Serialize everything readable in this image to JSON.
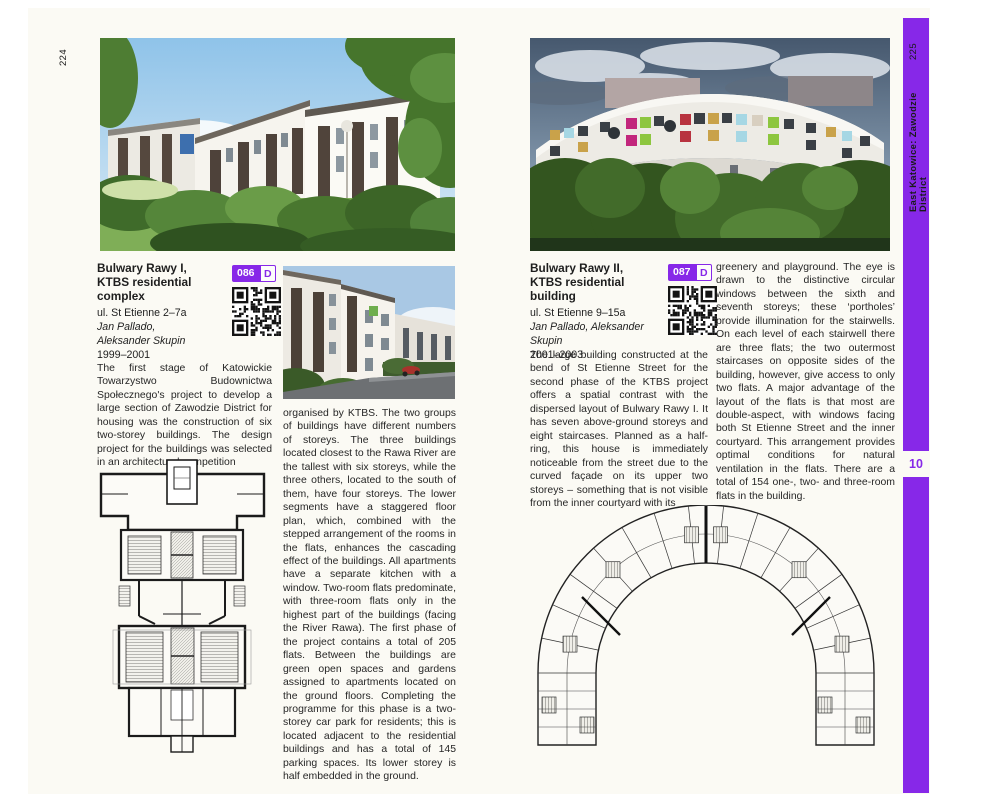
{
  "left_page": {
    "page_number": "224",
    "entry": {
      "title_line1": "Bulwary Rawy I,",
      "title_line2": "KTBS residential complex",
      "address": "ul. St Etienne 2–7a",
      "architect_line1": "Jan Pallado,",
      "architect_line2": "Aleksander Skupin",
      "years": "1999–2001",
      "badge_number": "086",
      "badge_letter": "D"
    },
    "col1_paragraph": "The first stage of Katowickie Towarzystwo Budownictwa Społecznego's project to develop a large section of Zawodzie District for housing was the construction of six two-storey buildings. The design project for the buildings was selected in an architectural competition",
    "col2_paragraph": "organised by KTBS. The two groups of buildings have different numbers of storeys. The three buildings located closest to the Rawa River are the tallest with six storeys, while the three others, located to the south of them, have four storeys. The lower segments have a staggered floor plan, which, combined with the stepped arrangement of the rooms in the flats, enhances the cascading effect of the buildings. All apartments have a separate kitchen with a window. Two-room flats predominate, with three-room flats only in the highest part of the buildings (facing the River Rawa). The first phase of the project contains a total of 205 flats. Between the buildings are green open spaces and gardens assigned to apartments located on the ground floors. Completing the programme for this phase is a two-storey car park for residents; this is located adjacent to the residential buildings and has a total of 145 parking spaces. Its lower storey is half embedded in the ground."
  },
  "right_page": {
    "page_number": "225",
    "tab_label": "East Katowice: Zawodzie District",
    "chapter_number": "10",
    "entry": {
      "title_line1": "Bulwary Rawy II,",
      "title_line2": "KTBS residential building",
      "address": "ul. St Etienne 9–15a",
      "architects": "Jan Pallado, Aleksander Skupin",
      "years": "2001–2003",
      "badge_number": "087",
      "badge_letter": "D"
    },
    "col1_paragraph": "The large building constructed at the bend of St Etienne Street for the second phase of the KTBS project offers a spatial contrast with the dispersed layout of Bulwary Rawy I. It has seven above-ground storeys and eight staircases. Planned as a half-ring, this house is immediately noticeable from the street due to the curved façade on its upper two storeys – something that is not visible from the inner courtyard with its",
    "col2_paragraph": "greenery and playground. The eye is drawn to the distinctive circular windows between the sixth and seventh storeys; these ‘portholes’ provide illumination for the stairwells. On each level of each stairwell there are three flats; the two outermost staircases on opposite sides of the building, however, give access to only two flats. A major advantage of the layout of the flats is that most are double-aspect, with windows facing both St Etienne Street and the inner courtyard. This arrangement provides optimal conditions for natural ventilation in the flats. There are a total of 154 one-, two- and three-room flats in the building."
  },
  "colors": {
    "accent_purple": "#8728e8",
    "page_background": "#fbfaf4",
    "facade_panels": [
      "#c2267c",
      "#b8333f",
      "#c9a24a",
      "#a6d7e4",
      "#8dc63f",
      "#d8cfc0"
    ]
  },
  "icons": {
    "qr_left": "qr-code",
    "qr_right": "qr-code"
  }
}
